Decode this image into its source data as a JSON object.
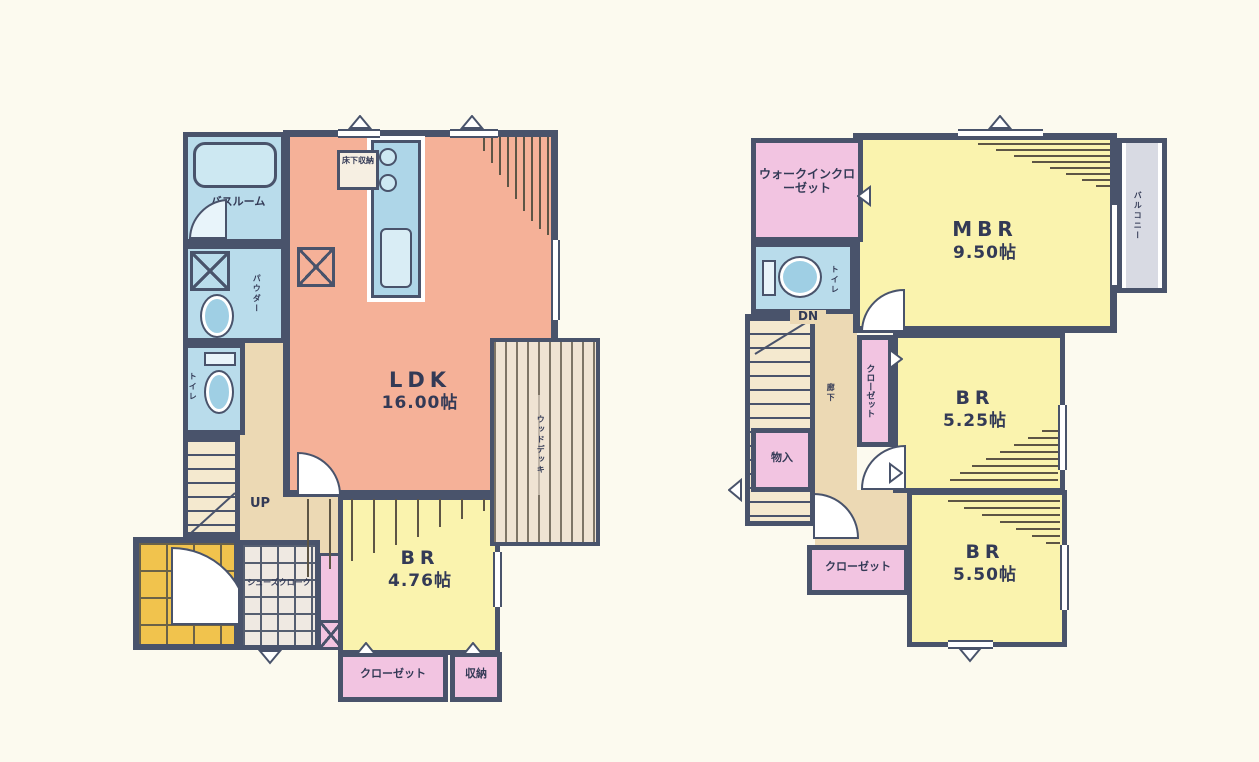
{
  "document": {
    "kind": "japanese-residential-floor-plan",
    "floors_shown": 2
  },
  "floor1": {
    "ldk": {
      "name": "LDK",
      "size": "16.00帖"
    },
    "br": {
      "name": "BR",
      "size": "4.76帖"
    },
    "bath": "バスルーム",
    "powder": "パウダー",
    "toilet": "トイレ",
    "underfloor_storage": "床下収納",
    "stairs": "UP",
    "shoe_closet": "シューズクローク",
    "closet": "クローゼット",
    "storage": "収納",
    "wood_deck": "ウッドデッキ"
  },
  "floor2": {
    "walk_in_closet": "ウォークインクローゼット",
    "mbr": {
      "name": "MBR",
      "size": "9.50帖"
    },
    "br1": {
      "name": "BR",
      "size": "5.25帖"
    },
    "br2": {
      "name": "BR",
      "size": "5.50帖"
    },
    "balcony": "バルコニー",
    "toilet": "トイレ",
    "stairs": "DN",
    "hallway": "廊下",
    "closet_side": "クローゼット",
    "storage": "物入",
    "closet_bottom": "クローゼット"
  },
  "colors": {
    "wall": "#49536b",
    "ldk_fill": "#f5b198",
    "bedroom_fill": "#faf3ae",
    "wet_area_fill": "#b9dceb",
    "closet_fill": "#f2c4e1",
    "hall_fill": "#ecd9b4",
    "entrance_tile": "#f1c34d",
    "balcony_fill": "#d8dae3",
    "paper": "#fcfaef",
    "text": "#333a56"
  }
}
